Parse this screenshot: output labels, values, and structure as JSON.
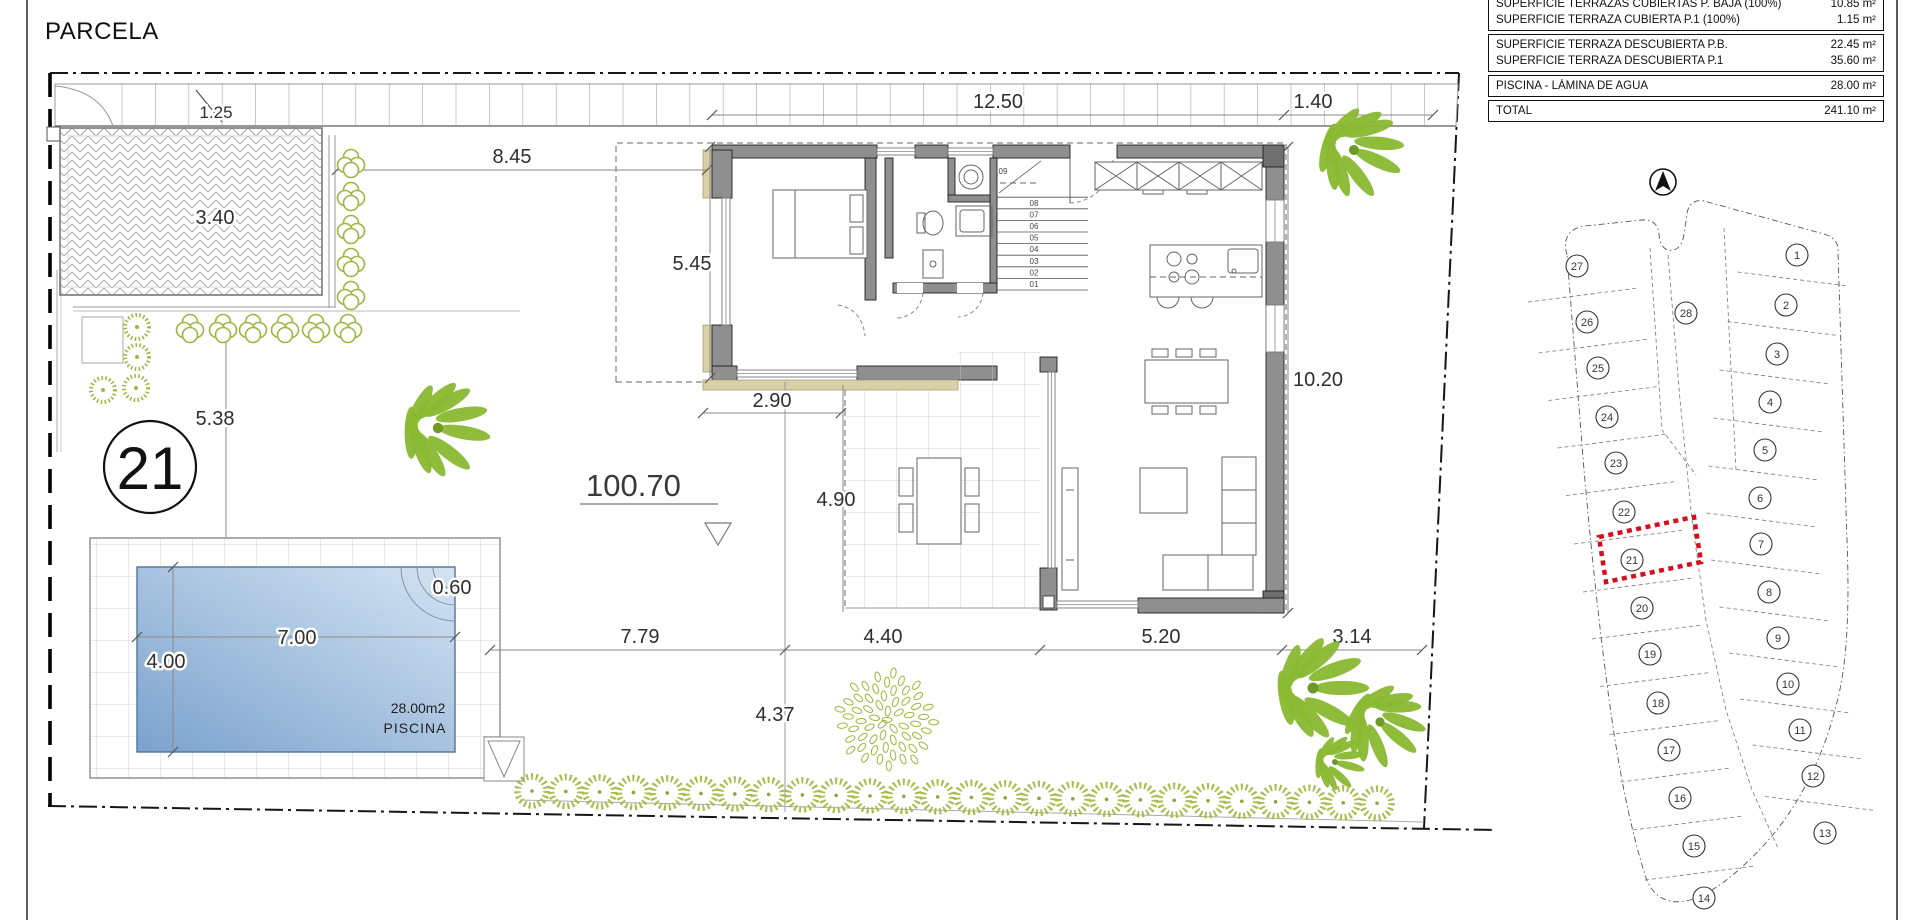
{
  "sheet": {
    "title": "PARCELA"
  },
  "area_table": {
    "groups": [
      {
        "rows": [
          {
            "label": "SUPERFICIE TERRAZAS CUBIERTAS P. BAJA (100%)",
            "value": "10.85 m²"
          },
          {
            "label": "SUPERFICIE TERRAZA CUBIERTA P.1 (100%)",
            "value": "1.15 m²"
          }
        ]
      },
      {
        "rows": [
          {
            "label": "SUPERFICIE TERRAZA DESCUBIERTA P.B.",
            "value": "22.45 m²"
          },
          {
            "label": "SUPERFICIE TERRAZA DESCUBIERTA P.1",
            "value": "35.60 m²"
          }
        ]
      },
      {
        "rows": [
          {
            "label": "PISCINA - LÁMINA DE AGUA",
            "value": "28.00 m²"
          }
        ]
      },
      {
        "rows": [
          {
            "label": "TOTAL",
            "value": "241.10 m²"
          }
        ]
      }
    ]
  },
  "plot": {
    "badge": "21",
    "level_marker": "100.70"
  },
  "pool": {
    "area": "28.00m2",
    "name": "PISCINA"
  },
  "dims": {
    "sidewalk": "1.25",
    "driveway": "3.40",
    "front_garden": "8.45",
    "house_top": "12.50",
    "house_top_right": "1.40",
    "house_left": "5.45",
    "side_garden": "5.38",
    "porch": "2.90",
    "terrace": "4.90",
    "house_right": "10.20",
    "bottom_a": "7.79",
    "bottom_b": "4.40",
    "bottom_c": "5.20",
    "bottom_d": "3.14",
    "rear_garden": "4.37",
    "pool_length": "7.00",
    "pool_width": "4.00",
    "pool_steps": "0.60"
  },
  "stairs": {
    "steps": [
      "01",
      "02",
      "03",
      "04",
      "05",
      "06",
      "07",
      "08",
      "09"
    ]
  },
  "minimap": {
    "highlighted_lot": "21",
    "lot_center": "28",
    "lots_left": [
      "27",
      "26",
      "25",
      "24",
      "23",
      "22",
      "21",
      "20",
      "19",
      "18",
      "17",
      "16",
      "15",
      "14"
    ],
    "lots_right": [
      "1",
      "2",
      "3",
      "4",
      "5",
      "6",
      "7",
      "8",
      "9",
      "10",
      "11",
      "12",
      "13"
    ]
  },
  "colors": {
    "highlight_red": "#d40f1e",
    "vegetation_green": "#8ab832",
    "pool_blue": "#7ba2cd",
    "wall_gray": "#8f8f8f"
  }
}
